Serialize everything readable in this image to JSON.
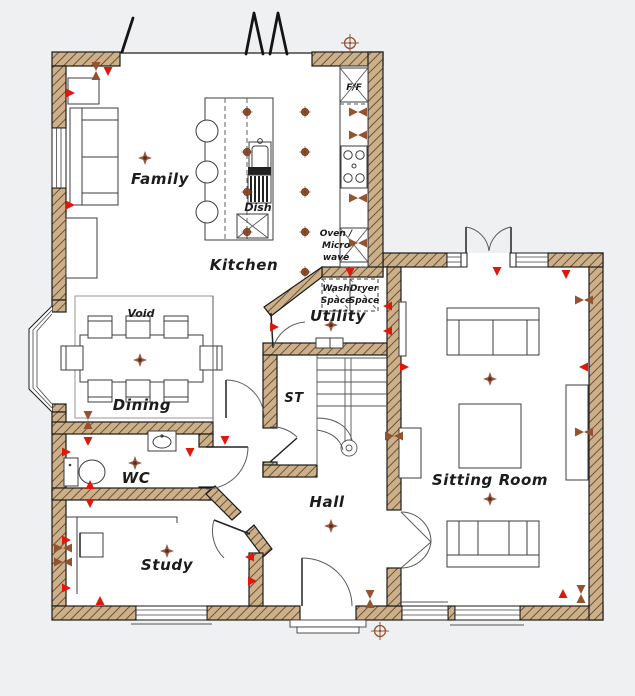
{
  "colors": {
    "background": "#eff0f1",
    "floor": "#ffffff",
    "wall_fill": "#cbb08a",
    "wall_hatch": "#6e5236",
    "outline": "#1b1b1b",
    "socket_red": "#e0180c",
    "symbol_brown": "#94522f",
    "light_brown": "#8a4528"
  },
  "labels": {
    "rooms": {
      "family": "Family",
      "kitchen": "Kitchen",
      "dining": "Dining",
      "utility": "Utility",
      "store": "ST",
      "wc": "WC",
      "hall": "Hall",
      "study": "Study",
      "sitting": "Sitting Room"
    },
    "annotations": {
      "void": "Void",
      "fridge_freezer": "F/F",
      "dishwasher": "Dish",
      "oven_line1": "Oven /",
      "oven_line2": "Micro",
      "oven_line3": "wave",
      "wash_line1": "Wash",
      "wash_line2": "Space",
      "dryer_line1": "Dryer",
      "dryer_line2": "Space"
    }
  },
  "symbols": {
    "ceiling_lights": [
      [
        145,
        158
      ],
      [
        140,
        360
      ],
      [
        135,
        463
      ],
      [
        167,
        551
      ],
      [
        331,
        526
      ],
      [
        331,
        325
      ],
      [
        490,
        379
      ],
      [
        490,
        499
      ]
    ],
    "downlights": [
      [
        247,
        112
      ],
      [
        247,
        152
      ],
      [
        247,
        192
      ],
      [
        247,
        232
      ],
      [
        305,
        112
      ],
      [
        305,
        152
      ],
      [
        305,
        192
      ],
      [
        305,
        232
      ],
      [
        305,
        272
      ]
    ],
    "sockets": [
      [
        108,
        71,
        90
      ],
      [
        70,
        93,
        0
      ],
      [
        70,
        205,
        0
      ],
      [
        88,
        441,
        90
      ],
      [
        190,
        452,
        90
      ],
      [
        66,
        452,
        0
      ],
      [
        90,
        485,
        270
      ],
      [
        90,
        503,
        90
      ],
      [
        66,
        540,
        0
      ],
      [
        66,
        588,
        0
      ],
      [
        100,
        601,
        270
      ],
      [
        250,
        557,
        180
      ],
      [
        252,
        581,
        0
      ],
      [
        225,
        440,
        90
      ],
      [
        274,
        327,
        0
      ],
      [
        388,
        306,
        180
      ],
      [
        388,
        331,
        180
      ],
      [
        350,
        272,
        90
      ],
      [
        497,
        271,
        90
      ],
      [
        566,
        274,
        90
      ],
      [
        584,
        367,
        180
      ],
      [
        404,
        367,
        0
      ],
      [
        563,
        594,
        270
      ]
    ],
    "tv_points": [
      [
        358,
        112,
        0
      ],
      [
        358,
        135,
        0
      ],
      [
        358,
        198,
        0
      ],
      [
        358,
        243,
        0
      ],
      [
        88,
        420,
        90
      ],
      [
        63,
        548,
        0
      ],
      [
        63,
        562,
        0
      ],
      [
        584,
        300,
        0
      ],
      [
        584,
        432,
        0
      ],
      [
        581,
        594,
        90
      ],
      [
        370,
        599,
        90
      ],
      [
        394,
        436,
        0
      ],
      [
        96,
        71,
        90
      ]
    ],
    "survey_markers": [
      [
        350,
        43
      ],
      [
        380,
        631
      ]
    ]
  }
}
